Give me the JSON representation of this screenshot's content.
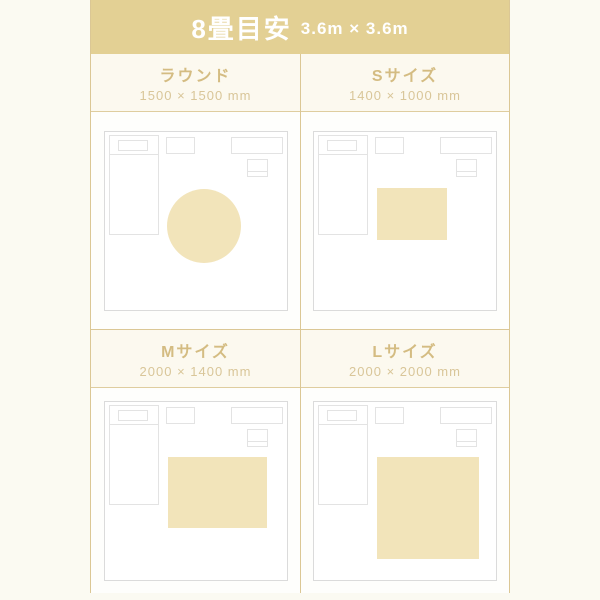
{
  "header": {
    "title": "8畳目安",
    "subtitle": "3.6m × 3.6m"
  },
  "colors": {
    "band_background": "#E3D094",
    "band_text": "#FFFFFF",
    "accent_text": "#D4BC82",
    "dims_text": "#D9C699",
    "grid_line": "#DBC795",
    "room_outline": "#DBDBDB",
    "furniture_outline": "#E3E3E3",
    "rug_fill": "#F2E4BA",
    "page_background": "#FBFAF2"
  },
  "cells": [
    {
      "id": "round",
      "title": "ラウンド",
      "dims": "1500 × 1500 mm",
      "rug": {
        "shape": "circle",
        "x": 62,
        "y": 57,
        "w": 74,
        "h": 74
      }
    },
    {
      "id": "s-size",
      "title": "Sサイズ",
      "dims": "1400 × 1000 mm",
      "rug": {
        "shape": "rect",
        "x": 63,
        "y": 56,
        "w": 70,
        "h": 52
      }
    },
    {
      "id": "m-size",
      "title": "Mサイズ",
      "dims": "2000 × 1400 mm",
      "rug": {
        "shape": "rect",
        "x": 63,
        "y": 55,
        "w": 99,
        "h": 71
      }
    },
    {
      "id": "l-size",
      "title": "Lサイズ",
      "dims": "2000 × 2000 mm",
      "rug": {
        "shape": "rect",
        "x": 63,
        "y": 55,
        "w": 102,
        "h": 102
      }
    }
  ]
}
